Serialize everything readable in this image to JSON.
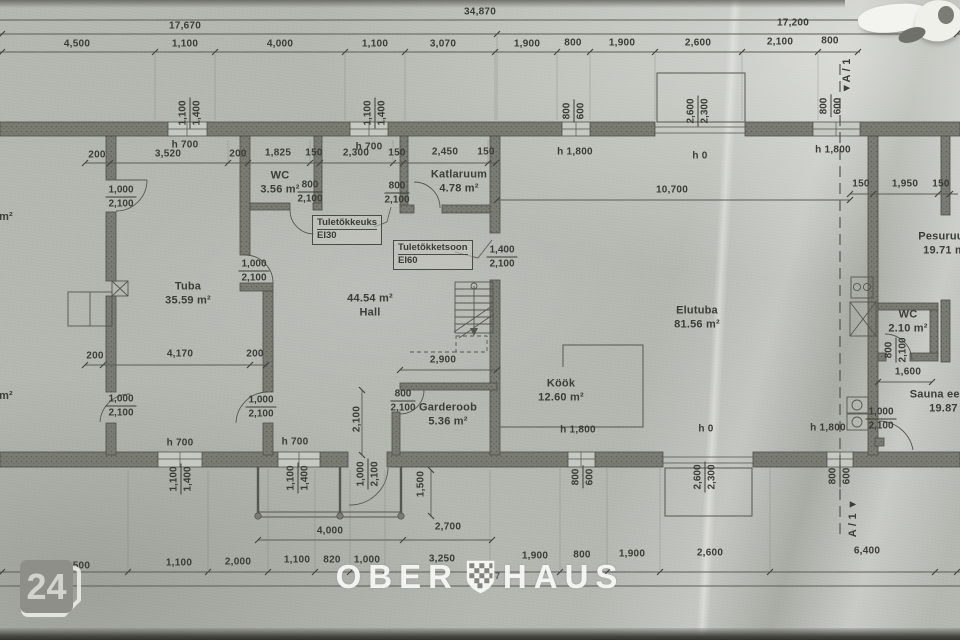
{
  "badge": {
    "number": "24"
  },
  "watermark": {
    "left": "OBER",
    "right": "HAUS",
    "logo": "checkered-shield"
  },
  "plan": {
    "dim_labels": [
      {
        "t": "34,870",
        "x": 480,
        "y": 12
      },
      {
        "t": "17,670",
        "x": 185,
        "y": 26
      },
      {
        "t": "17,200",
        "x": 793,
        "y": 23
      },
      {
        "t": "4,500",
        "x": 77,
        "y": 44
      },
      {
        "t": "1,100",
        "x": 185,
        "y": 44
      },
      {
        "t": "4,000",
        "x": 280,
        "y": 44
      },
      {
        "t": "1,100",
        "x": 375,
        "y": 44
      },
      {
        "t": "3,070",
        "x": 443,
        "y": 44
      },
      {
        "t": "1,900",
        "x": 527,
        "y": 44
      },
      {
        "t": "800",
        "x": 573,
        "y": 43
      },
      {
        "t": "1,900",
        "x": 622,
        "y": 43
      },
      {
        "t": "2,600",
        "x": 698,
        "y": 43
      },
      {
        "t": "2,100",
        "x": 780,
        "y": 42
      },
      {
        "t": "800",
        "x": 830,
        "y": 41
      },
      {
        "t": "200",
        "x": 97,
        "y": 155
      },
      {
        "t": "3,520",
        "x": 168,
        "y": 154
      },
      {
        "t": "200",
        "x": 238,
        "y": 154
      },
      {
        "t": "1,825",
        "x": 278,
        "y": 153
      },
      {
        "t": "150",
        "x": 314,
        "y": 153
      },
      {
        "t": "2,300",
        "x": 356,
        "y": 153
      },
      {
        "t": "150",
        "x": 397,
        "y": 153
      },
      {
        "t": "2,450",
        "x": 445,
        "y": 152
      },
      {
        "t": "150",
        "x": 486,
        "y": 152
      },
      {
        "t": "10,700",
        "x": 672,
        "y": 190
      },
      {
        "t": "150",
        "x": 861,
        "y": 184
      },
      {
        "t": "1,950",
        "x": 905,
        "y": 184
      },
      {
        "t": "150",
        "x": 941,
        "y": 184
      },
      {
        "t": "200",
        "x": 95,
        "y": 356
      },
      {
        "t": "4,170",
        "x": 180,
        "y": 354
      },
      {
        "t": "200",
        "x": 255,
        "y": 354
      },
      {
        "t": "2,900",
        "x": 443,
        "y": 360
      },
      {
        "t": "1,600",
        "x": 908,
        "y": 372
      },
      {
        "t": "4,000",
        "x": 330,
        "y": 531
      },
      {
        "t": "2,700",
        "x": 448,
        "y": 527
      },
      {
        "t": "4,500",
        "x": 77,
        "y": 566
      },
      {
        "t": "1,100",
        "x": 179,
        "y": 563
      },
      {
        "t": "2,000",
        "x": 238,
        "y": 562
      },
      {
        "t": "1,100",
        "x": 297,
        "y": 560
      },
      {
        "t": "820",
        "x": 332,
        "y": 560
      },
      {
        "t": "1,000",
        "x": 367,
        "y": 560
      },
      {
        "t": "3,250",
        "x": 442,
        "y": 559
      },
      {
        "t": "1,900",
        "x": 535,
        "y": 556
      },
      {
        "t": "800",
        "x": 582,
        "y": 555
      },
      {
        "t": "1,900",
        "x": 632,
        "y": 554
      },
      {
        "t": "2,600",
        "x": 710,
        "y": 553
      },
      {
        "t": "6,400",
        "x": 867,
        "y": 551
      },
      {
        "t": "1,87",
        "x": 491,
        "y": 576,
        "small": true
      }
    ],
    "height_labels": [
      {
        "t": "h 700",
        "x": 185,
        "y": 145
      },
      {
        "t": "h 700",
        "x": 369,
        "y": 147
      },
      {
        "t": "h 1,800",
        "x": 575,
        "y": 152
      },
      {
        "t": "h 0",
        "x": 700,
        "y": 156
      },
      {
        "t": "h 1,800",
        "x": 833,
        "y": 150
      },
      {
        "t": "h 700",
        "x": 180,
        "y": 443
      },
      {
        "t": "h 700",
        "x": 295,
        "y": 442
      },
      {
        "t": "h 1,800",
        "x": 578,
        "y": 430
      },
      {
        "t": "h 0",
        "x": 706,
        "y": 429
      },
      {
        "t": "h 1,800",
        "x": 828,
        "y": 428
      }
    ],
    "window_pairs": [
      {
        "a": "1,100",
        "b": "1,400",
        "x": 190,
        "y": 113
      },
      {
        "a": "1,100",
        "b": "1,400",
        "x": 375,
        "y": 113
      },
      {
        "a": "800",
        "b": "600",
        "x": 574,
        "y": 111
      },
      {
        "a": "2,600",
        "b": "2,300",
        "x": 698,
        "y": 111
      },
      {
        "a": "800",
        "b": "600",
        "x": 831,
        "y": 106
      },
      {
        "a": "1,100",
        "b": "1,400",
        "x": 181,
        "y": 479
      },
      {
        "a": "1,100",
        "b": "1,400",
        "x": 298,
        "y": 478
      },
      {
        "a": "1,000",
        "b": "2,100",
        "x": 368,
        "y": 474
      },
      {
        "a": "800",
        "b": "600",
        "x": 583,
        "y": 477
      },
      {
        "a": "2,600",
        "b": "2,300",
        "x": 705,
        "y": 477
      },
      {
        "a": "800",
        "b": "600",
        "x": 840,
        "y": 476
      },
      {
        "a": "800",
        "b": "2,100",
        "x": 896,
        "y": 350
      }
    ],
    "rotated_singles": [
      {
        "t": "1,500",
        "x": 421,
        "y": 484
      },
      {
        "t": "2,100",
        "x": 357,
        "y": 419
      }
    ],
    "door_labels": [
      {
        "a": "1,000",
        "b": "2,100",
        "x": 121,
        "y": 197
      },
      {
        "a": "1,000",
        "b": "2,100",
        "x": 254,
        "y": 271
      },
      {
        "a": "800",
        "b": "2,100",
        "x": 310,
        "y": 192
      },
      {
        "a": "800",
        "b": "2,100",
        "x": 397,
        "y": 193
      },
      {
        "a": "1,400",
        "b": "2,100",
        "x": 502,
        "y": 257
      },
      {
        "a": "1,000",
        "b": "2,100",
        "x": 121,
        "y": 406
      },
      {
        "a": "1,000",
        "b": "2,100",
        "x": 261,
        "y": 407
      },
      {
        "a": "800",
        "b": "2,100",
        "x": 403,
        "y": 401
      },
      {
        "a": "1,000",
        "b": "2,100",
        "x": 881,
        "y": 419
      }
    ],
    "rooms": [
      {
        "lines": [
          "Tuba",
          "35.59 m²"
        ],
        "x": 188,
        "y": 294
      },
      {
        "lines": [
          "44.54 m²",
          "Hall"
        ],
        "x": 370,
        "y": 306
      },
      {
        "lines": [
          "WC",
          "3.56 m²"
        ],
        "x": 280,
        "y": 183
      },
      {
        "lines": [
          "Katlaruum",
          "4.78 m²"
        ],
        "x": 459,
        "y": 182
      },
      {
        "lines": [
          "Köök",
          "12.60 m²"
        ],
        "x": 561,
        "y": 391
      },
      {
        "lines": [
          "Garderoob",
          "5.36 m²"
        ],
        "x": 448,
        "y": 415
      },
      {
        "lines": [
          "Elutuba",
          "81.56 m²"
        ],
        "x": 697,
        "y": 318
      },
      {
        "lines": [
          "Pesuruum",
          "19.71 m²"
        ],
        "x": 946,
        "y": 244
      },
      {
        "lines": [
          "WC",
          "2.10 m²"
        ],
        "x": 908,
        "y": 322
      },
      {
        "lines": [
          "Sauna eesruum",
          "19.87 m²"
        ],
        "x": 952,
        "y": 402
      },
      {
        "lines": [
          "m²"
        ],
        "x": 6,
        "y": 217
      },
      {
        "lines": [
          "m²"
        ],
        "x": 6,
        "y": 396
      }
    ],
    "fire_boxes": [
      {
        "line1": "Tuletõkkeuks",
        "line2": "EI30",
        "x": 312,
        "y": 215
      },
      {
        "line1": "Tuletõkketsoon",
        "line2": "EI60",
        "x": 393,
        "y": 240
      }
    ],
    "section_markers": [
      {
        "t": "▼A / 1",
        "x": 847,
        "y": 76
      },
      {
        "t": "A / 1 ▼",
        "x": 853,
        "y": 518
      }
    ]
  }
}
